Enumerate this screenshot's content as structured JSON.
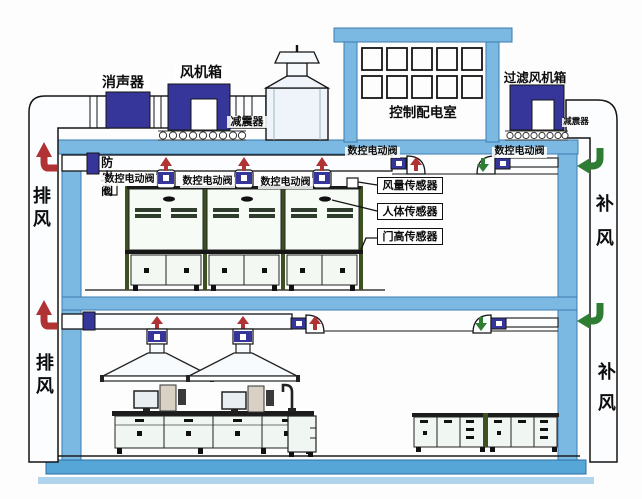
{
  "diagram_type": "laboratory-ventilation-system-diagram",
  "labels": {
    "silencer": "消声器",
    "fan_box": "风机箱",
    "shock_absorber": "减震器",
    "control_room": "控制配电室",
    "filter_fan_box": "过滤风机箱",
    "fire_damper": "防火阀",
    "nc_electric_valve": "数控电动阀",
    "air_volume_sensor": "风量传感器",
    "body_sensor": "人体传感器",
    "door_height_sensor": "门高传感器",
    "exhaust_air": "排风",
    "makeup_air": "补风"
  },
  "colors": {
    "structure_blue": "#7cb9e2",
    "equipment_navy": "#36369a",
    "exhaust_arrow_red": "#b03232",
    "supply_arrow_green": "#2f7d33",
    "ground_slab_blue": "#57a6d8",
    "hood_post_green": "#3c511f"
  }
}
